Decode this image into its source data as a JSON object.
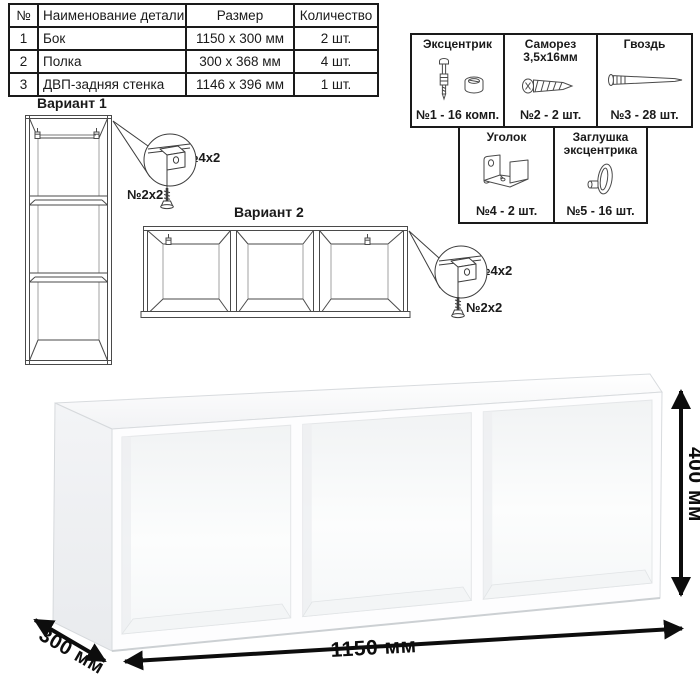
{
  "parts_table": {
    "headers": {
      "num": "№",
      "name": "Наименование детали",
      "size": "Размер",
      "qty": "Количество"
    },
    "rows": [
      {
        "num": "1",
        "name": "Бок",
        "size": "1150 x 300 мм",
        "qty": "2 шт."
      },
      {
        "num": "2",
        "name": "Полка",
        "size": "300 x 368 мм",
        "qty": "4 шт."
      },
      {
        "num": "3",
        "name": "ДВП-задняя стенка",
        "size": "1146 x 396 мм",
        "qty": "1 шт."
      }
    ]
  },
  "hardware_table": {
    "items": [
      {
        "name": "Эксцентрик",
        "icon": "eccentric-cam-icon",
        "count": "№1 - 16 комп."
      },
      {
        "name": "Саморез 3,5х16мм",
        "icon": "screw-icon",
        "count": "№2 - 2 шт."
      },
      {
        "name": "Гвоздь",
        "icon": "nail-icon",
        "count": "№3 - 28 шт."
      },
      {
        "name": "Уголок",
        "icon": "corner-bracket-icon",
        "count": "№4 - 2 шт."
      },
      {
        "name": "Заглушка эксцентрика",
        "icon": "eccentric-cap-icon",
        "count": "№5 - 16 шт."
      }
    ]
  },
  "variants": {
    "v1": {
      "title": "Вариант 1",
      "bracket_label": "№4х2",
      "screw_label": "№2х2"
    },
    "v2": {
      "title": "Вариант 2",
      "bracket_label": "№4х2",
      "screw_label": "№2х2"
    }
  },
  "dimensions": {
    "width_label": "1150 мм",
    "height_label": "400 мм",
    "depth_label": "300 мм"
  },
  "colors": {
    "diagram_line": "#4a4a4a",
    "dimension_line": "#111111",
    "table_border": "#1a1a1a"
  }
}
